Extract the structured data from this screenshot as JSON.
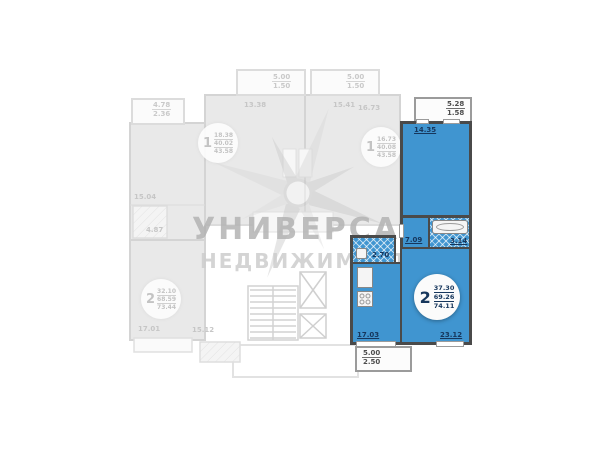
{
  "watermark": {
    "title": "УНИВЕРСАЛ",
    "subtitle": "НЕДВИЖИМОСТЬ"
  },
  "apartment": {
    "badge": {
      "rooms": "2",
      "living": "37.30",
      "total": "69.26",
      "total_balcony": "74.11"
    },
    "labels": {
      "bedroom": "14.35",
      "hall": "7.09",
      "bath": "3.14",
      "wc": "2.70",
      "kitchen": "17.03",
      "living_room": "23.12",
      "balcony_top_a": "5.28",
      "balcony_top_b": "1.58",
      "balcony_bottom_a": "5.00",
      "balcony_bottom_b": "2.50"
    }
  },
  "faded": {
    "badges": [
      {
        "rooms": "1",
        "l1": "18.38",
        "l2": "40.02",
        "l3": "43.58"
      },
      {
        "rooms": "1",
        "l1": "16.73",
        "l2": "40.08",
        "l3": "43.58"
      },
      {
        "rooms": "2",
        "l1": "32.10",
        "l2": "68.59",
        "l3": "73.44"
      }
    ],
    "labels": {
      "balcony_tl_a": "4.78",
      "balcony_tl_b": "2.36",
      "balcony_c1_a": "5.00",
      "balcony_c1_b": "1.50",
      "balcony_c2_a": "5.00",
      "balcony_c2_b": "1.50",
      "room_left": "15.04",
      "room_c1": "13.38",
      "room_c2": "15.41",
      "room_c3": "16.73",
      "bath_left": "4.87",
      "room_bl1": "17.01",
      "room_bl2": "15.12"
    }
  },
  "colors": {
    "highlight": "#4095d0",
    "wall": "#4a4a4a",
    "label": "#16365c",
    "faded": "#c6c6c6",
    "watermark_title": "#b3b3b3",
    "watermark_subtitle": "#cdcdcd"
  }
}
